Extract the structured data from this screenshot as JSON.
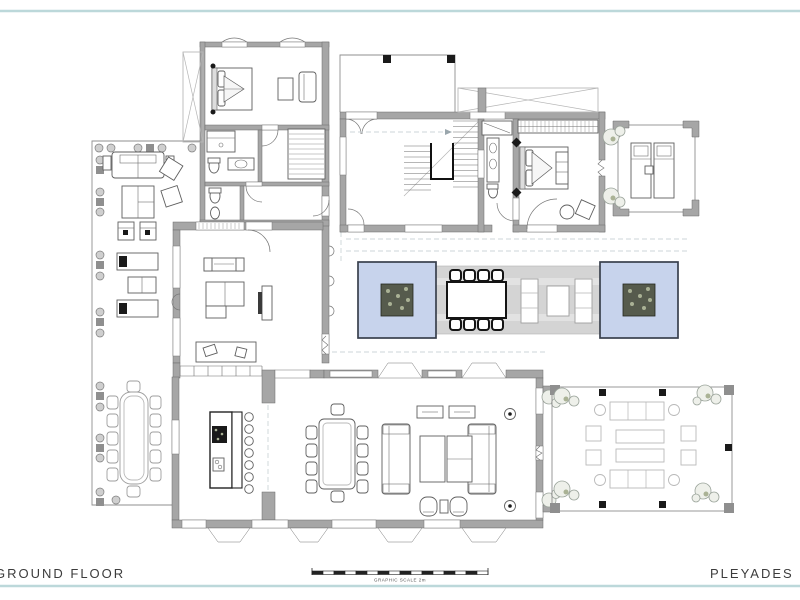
{
  "sheet": {
    "floor_label": "GROUND FLOOR",
    "project_label": "PLEYADES PLOT 1",
    "scale_caption": "GRAPHIC SCALE 2m"
  },
  "colors": {
    "sheet_border": "#bcd8da",
    "wall": "#a6a6a6",
    "pool": "#c7d3ec",
    "pool_border": "#39404d",
    "deck": "#d4d4d4",
    "planter": "#565b4d",
    "accent_black": "#141414",
    "text": "#3c3c3c"
  }
}
